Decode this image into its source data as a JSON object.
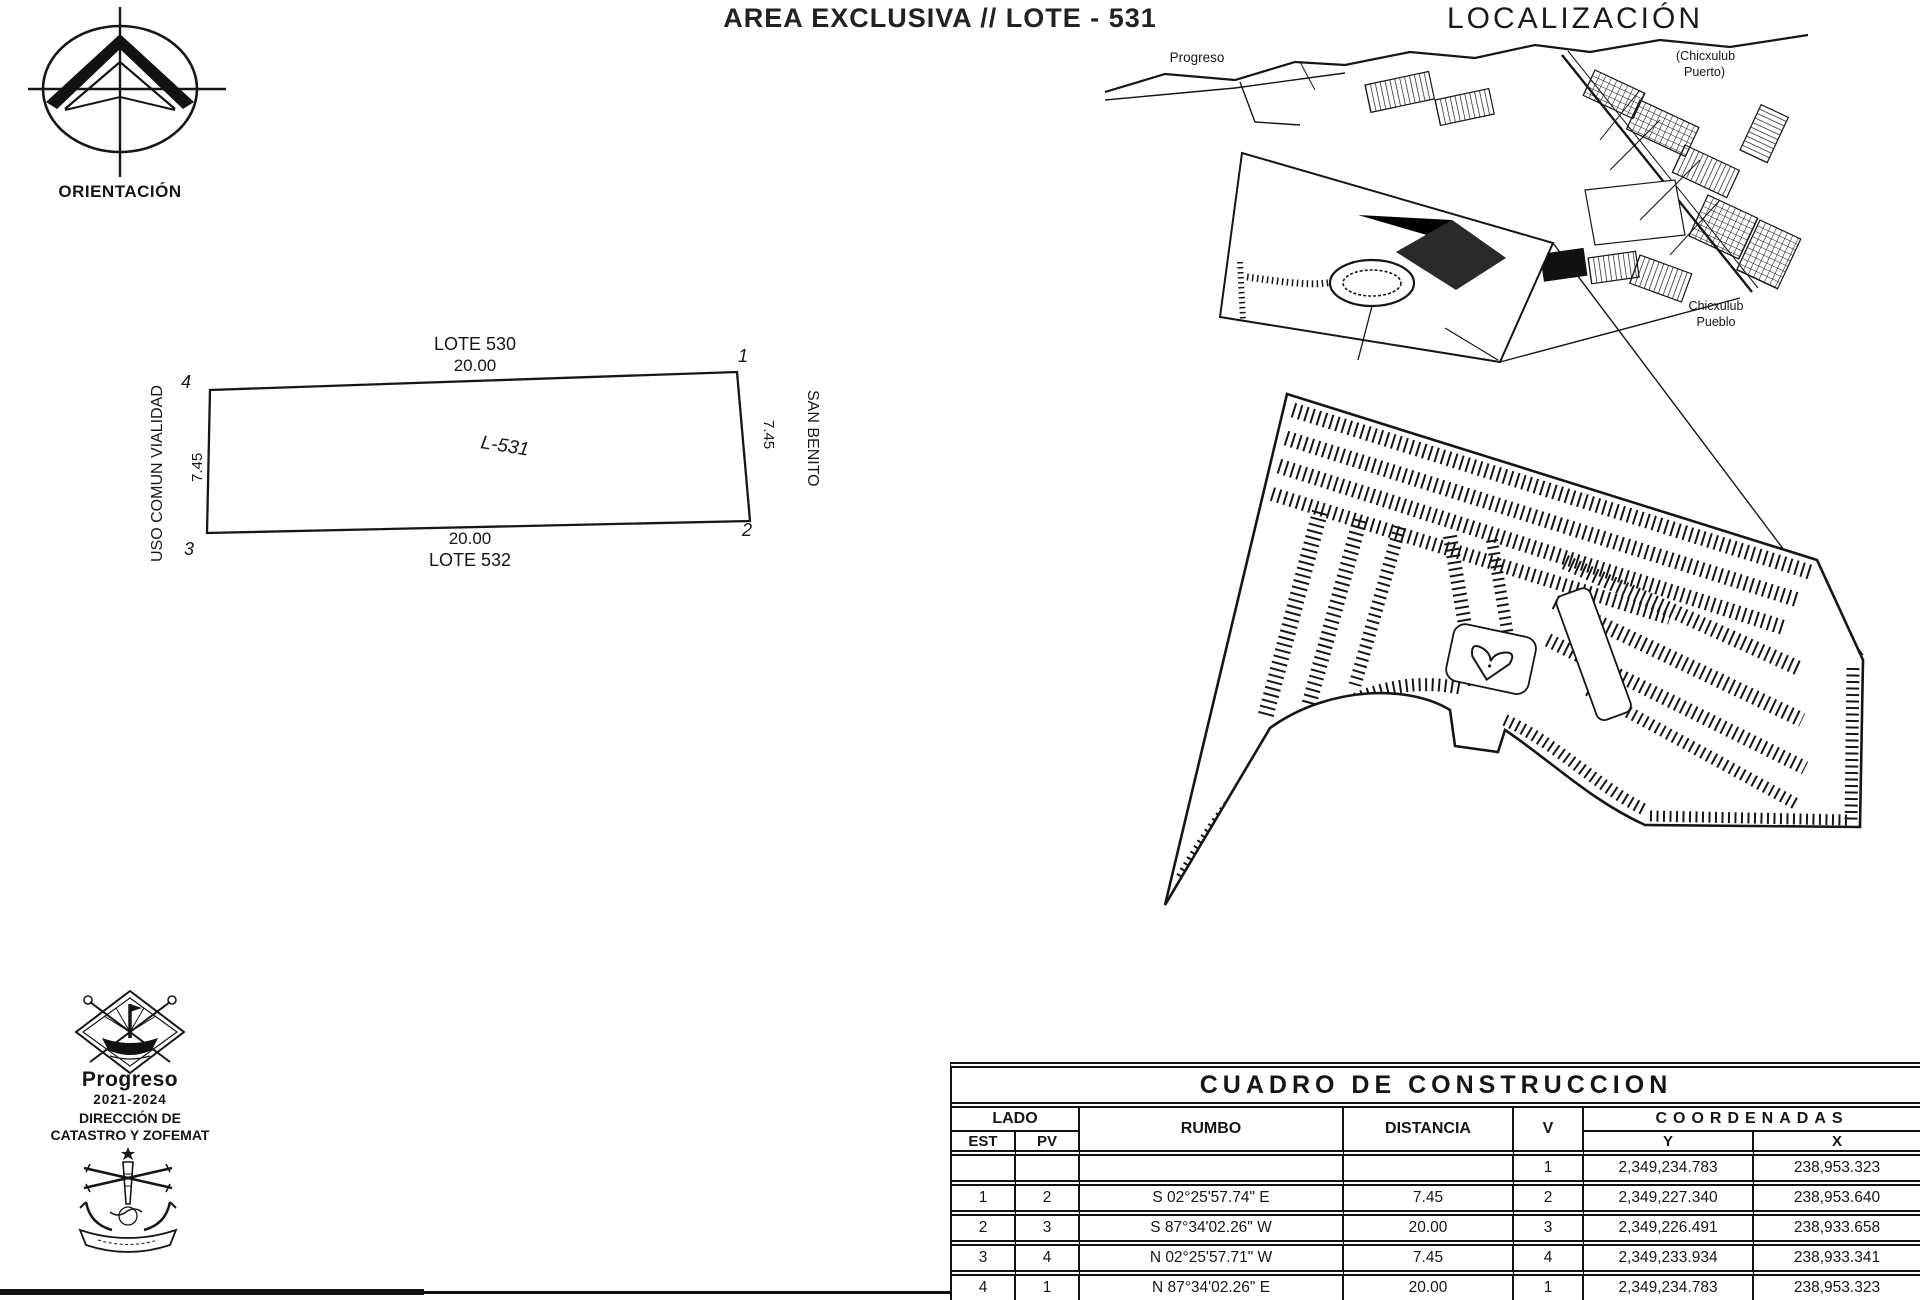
{
  "title": "AREA EXCLUSIVA // LOTE - 531",
  "orientation": {
    "label": "ORIENTACIÓN"
  },
  "localization": {
    "title": "LOCALIZACIÓN",
    "labels": {
      "progreso": "Progreso",
      "chicxulub_puerto_line1": "(Chicxulub",
      "chicxulub_puerto_line2": "Puerto)",
      "chicxulub_pueblo_line1": "Chicxulub",
      "chicxulub_pueblo_line2": "Pueblo"
    }
  },
  "lot_plan": {
    "north_lot": "LOTE 530",
    "north_length": "20.00",
    "south_length": "20.00",
    "south_lot": "LOTE 532",
    "west_label": "USO COMUN VIALIDAD",
    "west_length": "7.45",
    "east_label": "SAN BENITO",
    "east_length": "7.45",
    "lot_label": "L-531",
    "vertices": [
      "1",
      "2",
      "3",
      "4"
    ]
  },
  "stamps": {
    "municipality": "Progreso",
    "period": "2021-2024",
    "department_line1": "DIRECCIÓN DE",
    "department_line2": "CATASTRO Y ZOFEMAT"
  },
  "construction_table": {
    "title": "CUADRO DE CONSTRUCCION",
    "headers": {
      "lado": "LADO",
      "est": "EST",
      "pv": "PV",
      "rumbo": "RUMBO",
      "distancia": "DISTANCIA",
      "v": "V",
      "coordenadas": "COORDENADAS",
      "y": "Y",
      "x": "X"
    },
    "rows": [
      {
        "est": "",
        "pv": "",
        "rumbo": "",
        "distancia": "",
        "v": "1",
        "y": "2,349,234.783",
        "x": "238,953.323"
      },
      {
        "est": "1",
        "pv": "2",
        "rumbo": "S 02°25'57.74\" E",
        "distancia": "7.45",
        "v": "2",
        "y": "2,349,227.340",
        "x": "238,953.640"
      },
      {
        "est": "2",
        "pv": "3",
        "rumbo": "S 87°34'02.26\" W",
        "distancia": "20.00",
        "v": "3",
        "y": "2,349,226.491",
        "x": "238,933.658"
      },
      {
        "est": "3",
        "pv": "4",
        "rumbo": "N 02°25'57.71\" W",
        "distancia": "7.45",
        "v": "4",
        "y": "2,349,233.934",
        "x": "238,933.341"
      },
      {
        "est": "4",
        "pv": "1",
        "rumbo": "N 87°34'02.26\" E",
        "distancia": "20.00",
        "v": "1",
        "y": "2,349,234.783",
        "x": "238,953.323"
      }
    ]
  }
}
